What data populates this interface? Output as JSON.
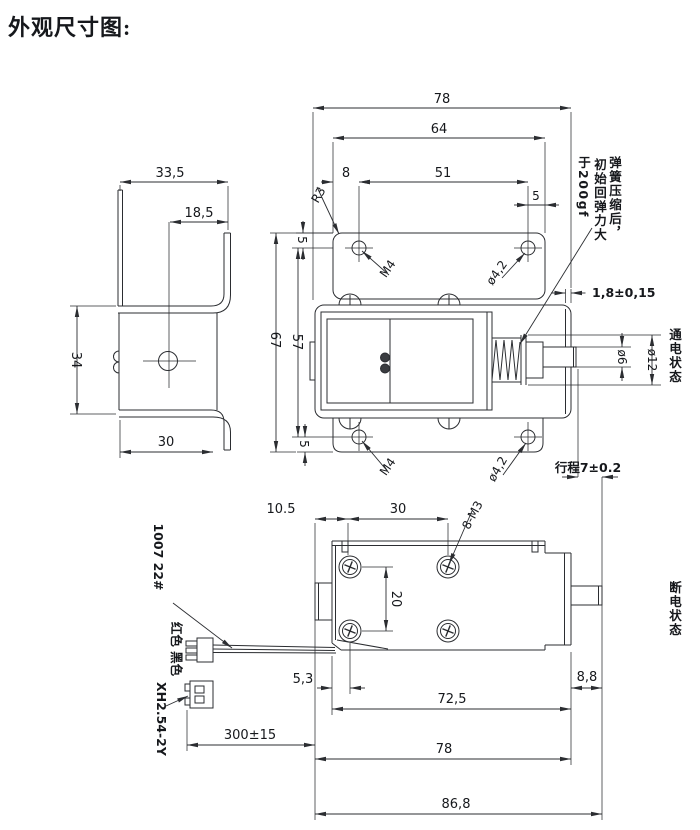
{
  "title": "外观尺寸图:",
  "side_view": {
    "top_width": "33,5",
    "hole_offset": "18,5",
    "height": "34",
    "bottom_width": "30"
  },
  "top_view": {
    "overall_width": "78",
    "plate_width": "64",
    "hole_left_offset": "8",
    "hole_spacing": "51",
    "hole_right_offset": "5",
    "hole_edge_offset": "5",
    "corner_radius": "R3",
    "thread": "M4",
    "hole_dia": "ø4,2"
  },
  "spring_note": {
    "line1": "弹簧压缩后，",
    "line2": "初始回弹力大",
    "line3": "于200gf"
  },
  "front_view": {
    "frame_height": "67",
    "hole_span": "57",
    "edge_offset": "5",
    "thread": "M4",
    "hole_dia": "ø4,2",
    "plate_thickness": "1,8±0,15",
    "shaft_dia": "ø6",
    "washer_dia": "ø12",
    "stroke": "行程7±0.2",
    "state_label": "通电状态"
  },
  "bottom_view": {
    "terminal_offset": "10.5",
    "screw_spacing_h": "30",
    "screw_spacing_v": "20",
    "screw_label": "8-M3",
    "screw_edge_offset": "5,3",
    "body_length": "72,5",
    "shaft_protrusion": "8,8",
    "body_overall": "78",
    "overall_length": "86,8",
    "wire_length": "300±15",
    "state_label": "断电状态"
  },
  "wiring": {
    "wire_spec": "1007 22#",
    "wire_colors": "红色 黑色",
    "connector": "XH2.54-2Y"
  }
}
